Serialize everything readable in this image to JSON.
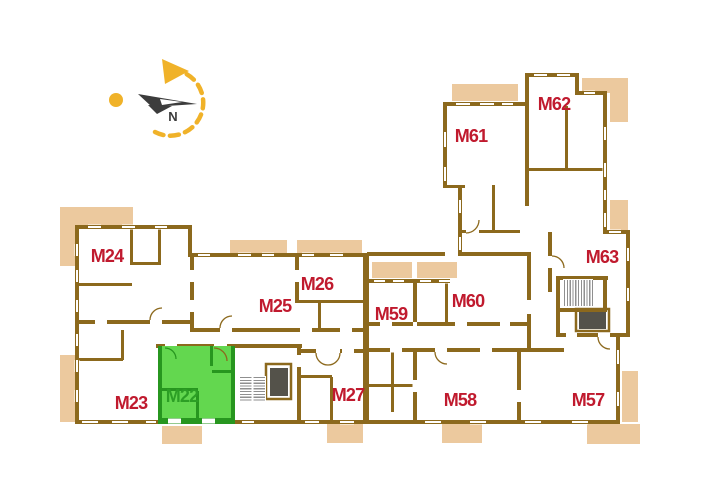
{
  "meta": {
    "kind": "building-floor-plan",
    "highlighted_unit": "M22"
  },
  "colors": {
    "wall": "#8c691d",
    "wall_light": "#9a7a2e",
    "balcony": "#ecc99e",
    "label_red": "#c01a2e",
    "label_green": "#2c9f25",
    "green_fill": "#63d74f",
    "green_wall": "#27961f",
    "stair_hatch": "#8f8f8f",
    "elevator": "#54524a",
    "compass_yellow": "#f0b229",
    "compass_needle": "#3c3c3c",
    "white": "#ffffff"
  },
  "units": [
    {
      "id": "M22",
      "label": "M22",
      "x": 182,
      "y": 396,
      "highlighted": true
    },
    {
      "id": "M23",
      "label": "M23",
      "x": 131,
      "y": 403,
      "highlighted": false
    },
    {
      "id": "M24",
      "label": "M24",
      "x": 107,
      "y": 256,
      "highlighted": false
    },
    {
      "id": "M25",
      "label": "M25",
      "x": 275,
      "y": 306,
      "highlighted": false
    },
    {
      "id": "M26",
      "label": "M26",
      "x": 317,
      "y": 284,
      "highlighted": false
    },
    {
      "id": "M27",
      "label": "M27",
      "x": 348,
      "y": 395,
      "highlighted": false
    },
    {
      "id": "M57",
      "label": "M57",
      "x": 588,
      "y": 400,
      "highlighted": false
    },
    {
      "id": "M58",
      "label": "M58",
      "x": 460,
      "y": 400,
      "highlighted": false
    },
    {
      "id": "M59",
      "label": "M59",
      "x": 391,
      "y": 314,
      "highlighted": false
    },
    {
      "id": "M60",
      "label": "M60",
      "x": 468,
      "y": 301,
      "highlighted": false
    },
    {
      "id": "M61",
      "label": "M61",
      "x": 471,
      "y": 136,
      "highlighted": false
    },
    {
      "id": "M62",
      "label": "M62",
      "x": 554,
      "y": 104,
      "highlighted": false
    },
    {
      "id": "M63",
      "label": "M63",
      "x": 602,
      "y": 257,
      "highlighted": false
    }
  ],
  "balconies_behind": [
    [
      60,
      207,
      73,
      59
    ],
    [
      60,
      355,
      15,
      67
    ],
    [
      162,
      426,
      40,
      18
    ],
    [
      230,
      240,
      57,
      13
    ],
    [
      297,
      240,
      65,
      13
    ],
    [
      452,
      84,
      66,
      17
    ],
    [
      582,
      78,
      46,
      15
    ],
    [
      610,
      93,
      18,
      29
    ],
    [
      610,
      200,
      18,
      32
    ],
    [
      622,
      371,
      16,
      51
    ],
    [
      587,
      424,
      53,
      20
    ],
    [
      327,
      424,
      36,
      19
    ],
    [
      442,
      424,
      40,
      19
    ]
  ],
  "balconies_inset": [
    [
      372,
      262,
      40,
      16
    ],
    [
      417,
      262,
      40,
      16
    ]
  ],
  "footprints": [
    [
      77,
      227,
      115,
      195
    ],
    [
      192,
      253,
      175,
      169
    ],
    [
      367,
      255,
      253,
      167
    ],
    [
      445,
      104,
      82,
      151
    ],
    [
      527,
      75,
      50,
      159
    ],
    [
      577,
      93,
      26,
      141
    ],
    [
      548,
      232,
      80,
      105
    ]
  ],
  "walls": [
    [
      77,
      225,
      115,
      4
    ],
    [
      75,
      225,
      4,
      199
    ],
    [
      75,
      420,
      545,
      4
    ],
    [
      188,
      225,
      4,
      32
    ],
    [
      188,
      253,
      181,
      4
    ],
    [
      363,
      253,
      6,
      171
    ],
    [
      367,
      252,
      78,
      4
    ],
    [
      458,
      252,
      72,
      4
    ],
    [
      367,
      279,
      78,
      4
    ],
    [
      443,
      102,
      4,
      86
    ],
    [
      443,
      185,
      22,
      3
    ],
    [
      458,
      188,
      4,
      67
    ],
    [
      443,
      102,
      86,
      4
    ],
    [
      525,
      73,
      4,
      33
    ],
    [
      525,
      73,
      54,
      4
    ],
    [
      575,
      73,
      4,
      22
    ],
    [
      575,
      91,
      32,
      4
    ],
    [
      603,
      91,
      4,
      143
    ],
    [
      603,
      230,
      27,
      4
    ],
    [
      626,
      230,
      4,
      107
    ],
    [
      556,
      333,
      74,
      4
    ],
    [
      616,
      333,
      4,
      91
    ],
    [
      75,
      320,
      117,
      4
    ],
    [
      130,
      229,
      3,
      36
    ],
    [
      158,
      229,
      3,
      36
    ],
    [
      130,
      262,
      31,
      3
    ],
    [
      77,
      283,
      55,
      3
    ],
    [
      121,
      330,
      3,
      30
    ],
    [
      77,
      358,
      46,
      3
    ],
    [
      190,
      253,
      4,
      79
    ],
    [
      192,
      328,
      175,
      4
    ],
    [
      156,
      344,
      146,
      4
    ],
    [
      297,
      344,
      4,
      80
    ],
    [
      300,
      349,
      67,
      4
    ],
    [
      295,
      253,
      4,
      50
    ],
    [
      295,
      300,
      72,
      3
    ],
    [
      318,
      300,
      3,
      31
    ],
    [
      301,
      375,
      31,
      3
    ],
    [
      330,
      377,
      3,
      45
    ],
    [
      367,
      322,
      46,
      4
    ],
    [
      417,
      322,
      110,
      4
    ],
    [
      367,
      348,
      153,
      4
    ],
    [
      413,
      348,
      4,
      72
    ],
    [
      517,
      348,
      4,
      72
    ],
    [
      520,
      348,
      44,
      4
    ],
    [
      367,
      384,
      46,
      3
    ],
    [
      391,
      352,
      3,
      60
    ],
    [
      492,
      185,
      3,
      46
    ],
    [
      460,
      230,
      60,
      3
    ],
    [
      529,
      168,
      74,
      3
    ],
    [
      565,
      106,
      3,
      62
    ],
    [
      525,
      106,
      4,
      100
    ],
    [
      445,
      283,
      3,
      39
    ],
    [
      548,
      232,
      4,
      60
    ],
    [
      413,
      281,
      4,
      41
    ],
    [
      527,
      252,
      4,
      96
    ],
    [
      556,
      276,
      52,
      4
    ],
    [
      556,
      276,
      4,
      61
    ],
    [
      558,
      308,
      48,
      4
    ],
    [
      603,
      276,
      4,
      36
    ]
  ],
  "elevator_frames": [
    [
      266,
      364,
      25,
      35
    ],
    [
      576,
      309,
      33,
      22
    ]
  ],
  "windows": [
    {
      "o": "h",
      "x": 88,
      "y": 225,
      "l": 13
    },
    {
      "o": "h",
      "x": 122,
      "y": 225,
      "l": 13
    },
    {
      "o": "h",
      "x": 155,
      "y": 225,
      "l": 12
    },
    {
      "o": "v",
      "x": 75,
      "y": 244,
      "l": 12
    },
    {
      "o": "v",
      "x": 75,
      "y": 270,
      "l": 12
    },
    {
      "o": "v",
      "x": 75,
      "y": 300,
      "l": 12
    },
    {
      "o": "v",
      "x": 75,
      "y": 334,
      "l": 12
    },
    {
      "o": "v",
      "x": 75,
      "y": 360,
      "l": 12
    },
    {
      "o": "v",
      "x": 75,
      "y": 390,
      "l": 12
    },
    {
      "o": "h",
      "x": 82,
      "y": 420,
      "l": 16
    },
    {
      "o": "h",
      "x": 112,
      "y": 420,
      "l": 16
    },
    {
      "o": "h",
      "x": 146,
      "y": 420,
      "l": 10
    },
    {
      "o": "h",
      "x": 242,
      "y": 420,
      "l": 12
    },
    {
      "o": "h",
      "x": 305,
      "y": 420,
      "l": 14
    },
    {
      "o": "h",
      "x": 340,
      "y": 420,
      "l": 14
    },
    {
      "o": "h",
      "x": 425,
      "y": 420,
      "l": 16
    },
    {
      "o": "h",
      "x": 470,
      "y": 420,
      "l": 16
    },
    {
      "o": "h",
      "x": 525,
      "y": 420,
      "l": 16
    },
    {
      "o": "h",
      "x": 572,
      "y": 420,
      "l": 16
    },
    {
      "o": "h",
      "x": 198,
      "y": 253,
      "l": 12
    },
    {
      "o": "h",
      "x": 238,
      "y": 253,
      "l": 13
    },
    {
      "o": "h",
      "x": 262,
      "y": 253,
      "l": 12
    },
    {
      "o": "h",
      "x": 302,
      "y": 253,
      "l": 12
    },
    {
      "o": "h",
      "x": 330,
      "y": 253,
      "l": 13
    },
    {
      "o": "h",
      "x": 374,
      "y": 279,
      "l": 11
    },
    {
      "o": "h",
      "x": 393,
      "y": 279,
      "l": 11
    },
    {
      "o": "h",
      "x": 420,
      "y": 279,
      "l": 11
    },
    {
      "o": "h",
      "x": 439,
      "y": 279,
      "l": 11
    },
    {
      "o": "h",
      "x": 456,
      "y": 102,
      "l": 14
    },
    {
      "o": "h",
      "x": 480,
      "y": 102,
      "l": 14
    },
    {
      "o": "h",
      "x": 502,
      "y": 102,
      "l": 11
    },
    {
      "o": "h",
      "x": 534,
      "y": 73,
      "l": 13
    },
    {
      "o": "h",
      "x": 557,
      "y": 73,
      "l": 13
    },
    {
      "o": "h",
      "x": 584,
      "y": 91,
      "l": 11
    },
    {
      "o": "v",
      "x": 443,
      "y": 132,
      "l": 15
    },
    {
      "o": "v",
      "x": 443,
      "y": 167,
      "l": 14
    },
    {
      "o": "v",
      "x": 458,
      "y": 200,
      "l": 13
    },
    {
      "o": "v",
      "x": 458,
      "y": 237,
      "l": 13
    },
    {
      "o": "v",
      "x": 603,
      "y": 127,
      "l": 13
    },
    {
      "o": "v",
      "x": 603,
      "y": 163,
      "l": 14
    },
    {
      "o": "v",
      "x": 603,
      "y": 190,
      "l": 10
    },
    {
      "o": "v",
      "x": 603,
      "y": 213,
      "l": 14
    },
    {
      "o": "v",
      "x": 626,
      "y": 248,
      "l": 13
    },
    {
      "o": "v",
      "x": 626,
      "y": 288,
      "l": 13
    },
    {
      "o": "h",
      "x": 609,
      "y": 230,
      "l": 12
    },
    {
      "o": "v",
      "x": 616,
      "y": 350,
      "l": 14
    },
    {
      "o": "v",
      "x": 616,
      "y": 392,
      "l": 14
    }
  ],
  "door_gaps": [
    {
      "o": "h",
      "x": 214,
      "y": 344,
      "l": 13
    },
    {
      "o": "h",
      "x": 316,
      "y": 349,
      "l": 24
    },
    {
      "o": "h",
      "x": 598,
      "y": 333,
      "l": 12
    },
    {
      "o": "h",
      "x": 150,
      "y": 320,
      "l": 12
    },
    {
      "o": "h",
      "x": 95,
      "y": 320,
      "l": 12
    },
    {
      "o": "h",
      "x": 220,
      "y": 328,
      "l": 12
    },
    {
      "o": "h",
      "x": 300,
      "y": 328,
      "l": 12
    },
    {
      "o": "h",
      "x": 340,
      "y": 328,
      "l": 12
    },
    {
      "o": "h",
      "x": 390,
      "y": 348,
      "l": 12
    },
    {
      "o": "h",
      "x": 435,
      "y": 348,
      "l": 12
    },
    {
      "o": "h",
      "x": 480,
      "y": 348,
      "l": 12
    },
    {
      "o": "h",
      "x": 380,
      "y": 322,
      "l": 12
    },
    {
      "o": "h",
      "x": 455,
      "y": 322,
      "l": 12
    },
    {
      "o": "h",
      "x": 500,
      "y": 322,
      "l": 10
    },
    {
      "o": "h",
      "x": 466,
      "y": 230,
      "l": 13
    },
    {
      "o": "h",
      "x": 566,
      "y": 333,
      "l": 11
    },
    {
      "o": "h",
      "x": 165,
      "y": 344,
      "l": 12
    },
    {
      "o": "h",
      "x": 342,
      "y": 349,
      "l": 12
    },
    {
      "o": "v",
      "x": 548,
      "y": 256,
      "l": 12
    },
    {
      "o": "v",
      "x": 527,
      "y": 300,
      "l": 14
    },
    {
      "o": "v",
      "x": 297,
      "y": 355,
      "l": 12
    },
    {
      "o": "v",
      "x": 190,
      "y": 270,
      "l": 12
    },
    {
      "o": "v",
      "x": 190,
      "y": 300,
      "l": 12
    },
    {
      "o": "v",
      "x": 413,
      "y": 380,
      "l": 12
    },
    {
      "o": "v",
      "x": 517,
      "y": 390,
      "l": 12
    },
    {
      "o": "v",
      "x": 295,
      "y": 270,
      "l": 12
    }
  ],
  "doors": [
    "M 214 348 A 13 13 0 0 1 227 361",
    "M 316 353 A 12 12 0 0 0 328 365",
    "M 340 353 A 12 12 0 0 1 328 365",
    "M 220 328 A 12 12 0 0 1 232 316",
    "M 435 352 A 12 12 0 0 0 447 364",
    "M 552 256 A 12 12 0 0 1 564 268",
    "M 598 337 A 12 12 0 0 0 610 349",
    "M 150 320 A 12 12 0 0 1 162 308",
    "M 466 233 A 13 13 0 0 0 479 220"
  ],
  "green_unit": {
    "fill": [
      160,
      346,
      73,
      74
    ],
    "walls": [
      [
        158,
        346,
        4,
        74
      ],
      [
        231,
        346,
        4,
        74
      ],
      [
        158,
        418,
        77,
        6
      ],
      [
        160,
        388,
        38,
        3
      ],
      [
        196,
        391,
        3,
        29
      ],
      [
        210,
        346,
        3,
        20
      ],
      [
        212,
        370,
        21,
        3
      ]
    ],
    "window_gaps": [
      [
        168,
        418,
        13
      ],
      [
        202,
        418,
        13
      ]
    ],
    "door": "M 165 348 A 11 11 0 0 1 176 359"
  },
  "stairs": [
    {
      "x": 240,
      "y": 377,
      "w": 25,
      "h": 25,
      "dir": "h"
    },
    {
      "x": 564,
      "y": 280,
      "w": 28,
      "h": 26,
      "dir": "v"
    }
  ],
  "elevators": [
    [
      270,
      368,
      18,
      28
    ],
    [
      579,
      312,
      27,
      17
    ]
  ],
  "compass": {
    "n_label": "N",
    "arc_path": "M 155 132 A 33 33 0 1 0 166 70",
    "arc_dash": "9 6.5",
    "arrowhead": "162,59 189,71 165,84",
    "dot": {
      "cx": 116,
      "cy": 100,
      "r": 7
    },
    "needle_main": "138,94 197,104 152,107",
    "needle_fin": "148,105 172,106 157,114",
    "needle_notch": "160,99 182,102 162,105",
    "n_pos": {
      "x": 173,
      "y": 121
    }
  }
}
